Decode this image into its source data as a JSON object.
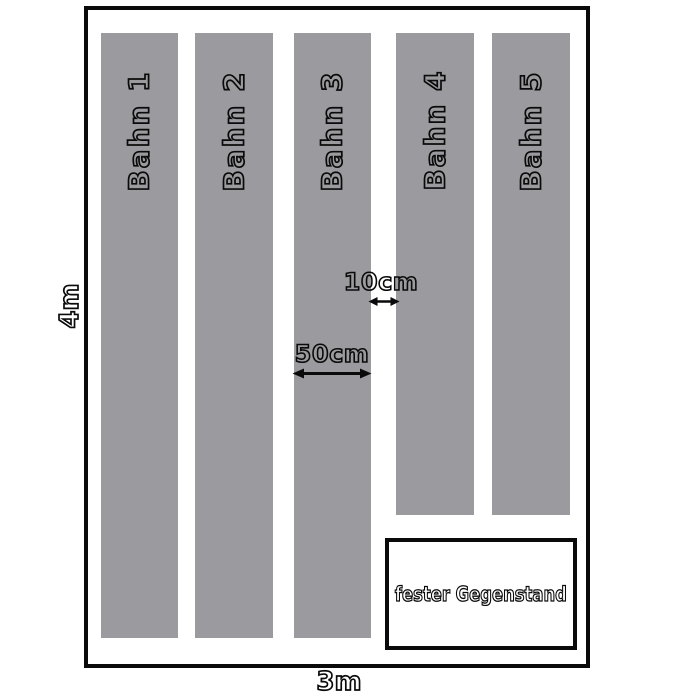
{
  "diagram": {
    "description": "Raumplan mit Tapetenbahnen",
    "colors": {
      "background": "#ffffff",
      "lane_fill": "#9b9b9f",
      "line": "#0a0a0a"
    },
    "room": {
      "height_label": "4m",
      "width_label": "3m"
    },
    "lanes": [
      {
        "label": "Bahn 1"
      },
      {
        "label": "Bahn 2"
      },
      {
        "label": "Bahn 3"
      },
      {
        "label": "Bahn 4"
      },
      {
        "label": "Bahn 5"
      }
    ],
    "dimensions": {
      "gap_label": "10cm",
      "lane_width_label": "50cm"
    },
    "fixed_object": {
      "label": "fester Gegenstand"
    }
  }
}
